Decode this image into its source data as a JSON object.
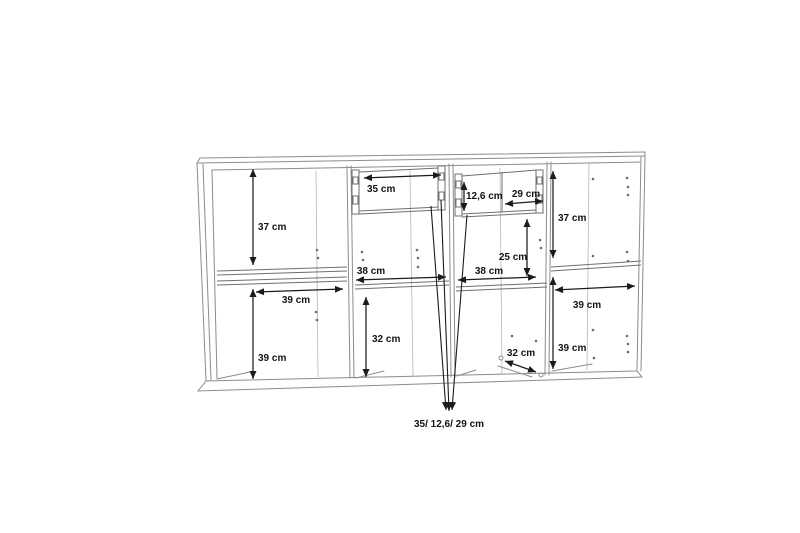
{
  "diagram": {
    "kind": "furniture dimension drawing",
    "subject": "four-section sideboard with two drawers, interior measurements",
    "unit": "cm"
  },
  "dim_labels": {
    "s1_top_height": "37 cm",
    "s1_shelf_width": "39 cm",
    "s1_bottom_height": "39 cm",
    "s2_drawer_width": "35 cm",
    "s2_shelf_width": "38 cm",
    "s2_bottom_height": "32 cm",
    "s3_drawer_height": "12,6 cm",
    "s3_drawer_width": "29 cm",
    "s3_mid_height": "25 cm",
    "s3_shelf_width": "38 cm",
    "s3_bottom_depth": "32 cm",
    "s4_top_height": "37 cm",
    "s4_shelf_width": "39 cm",
    "s4_bottom_height": "39 cm",
    "drawer_summary": "35/ 12,6/ 29 cm"
  },
  "dimensions_cm": {
    "section1": {
      "top_height": 37,
      "width": 39,
      "bottom_height": 39
    },
    "section2": {
      "drawer_width": 35,
      "width": 38,
      "bottom_height": 32
    },
    "section3": {
      "drawer_height": 12.6,
      "drawer_width": 29,
      "mid_height": 25,
      "width": 38,
      "bottom_depth": 32
    },
    "section4": {
      "top_height": 37,
      "width": 39,
      "bottom_height": 39
    },
    "drawer_summary": [
      35,
      12.6,
      29
    ]
  }
}
